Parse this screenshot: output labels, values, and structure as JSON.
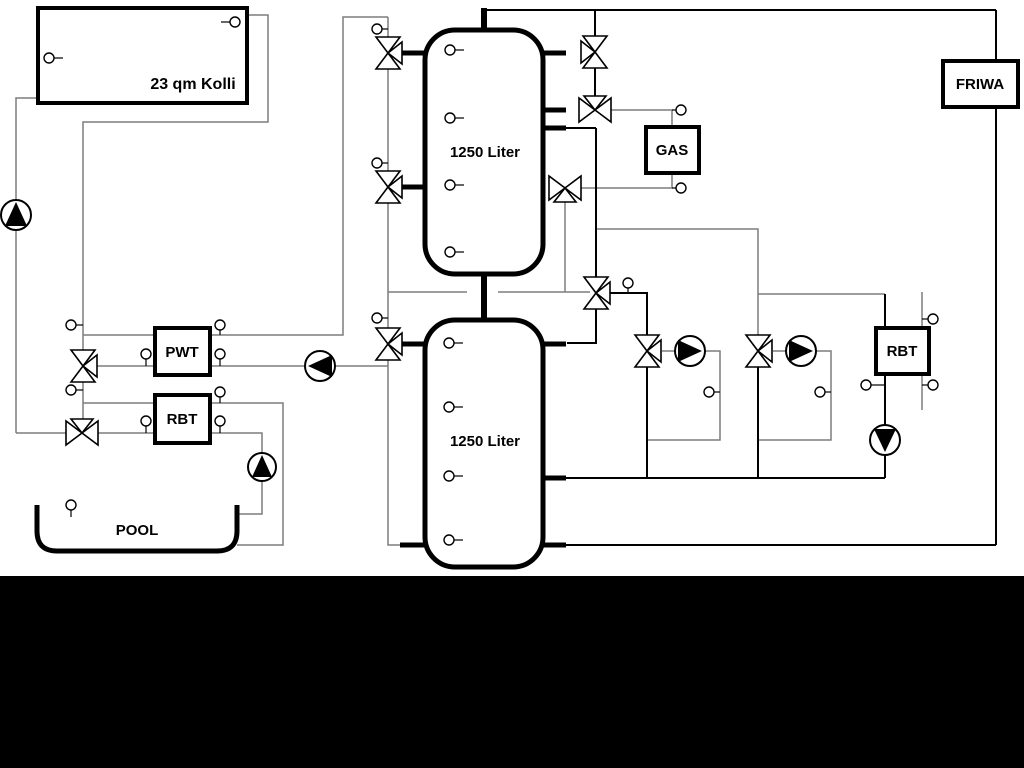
{
  "labels": {
    "collector": "23 qm Kolli",
    "tank_upper": "1250 Liter",
    "tank_lower": "1250 Liter",
    "pwt": "PWT",
    "rbt_left": "RBT",
    "gas": "GAS",
    "friwa": "FRIWA",
    "rbt_right": "RBT",
    "pool": "POOL"
  },
  "colors": {
    "background": "#ffffff",
    "letterbox": "#000000",
    "pipe_primary": "#000000",
    "pipe_secondary": "#7d7d7d",
    "component_fill": "#ffffff"
  },
  "icons": {
    "three_way_valve": "bowtie-of-triangles",
    "pump": "circle-with-flow-triangle",
    "sensor_port": "small-circle-with-stem"
  },
  "inventory": {
    "tanks": 2,
    "valves": 11,
    "pumps": 6,
    "sensor_ports": 30
  }
}
